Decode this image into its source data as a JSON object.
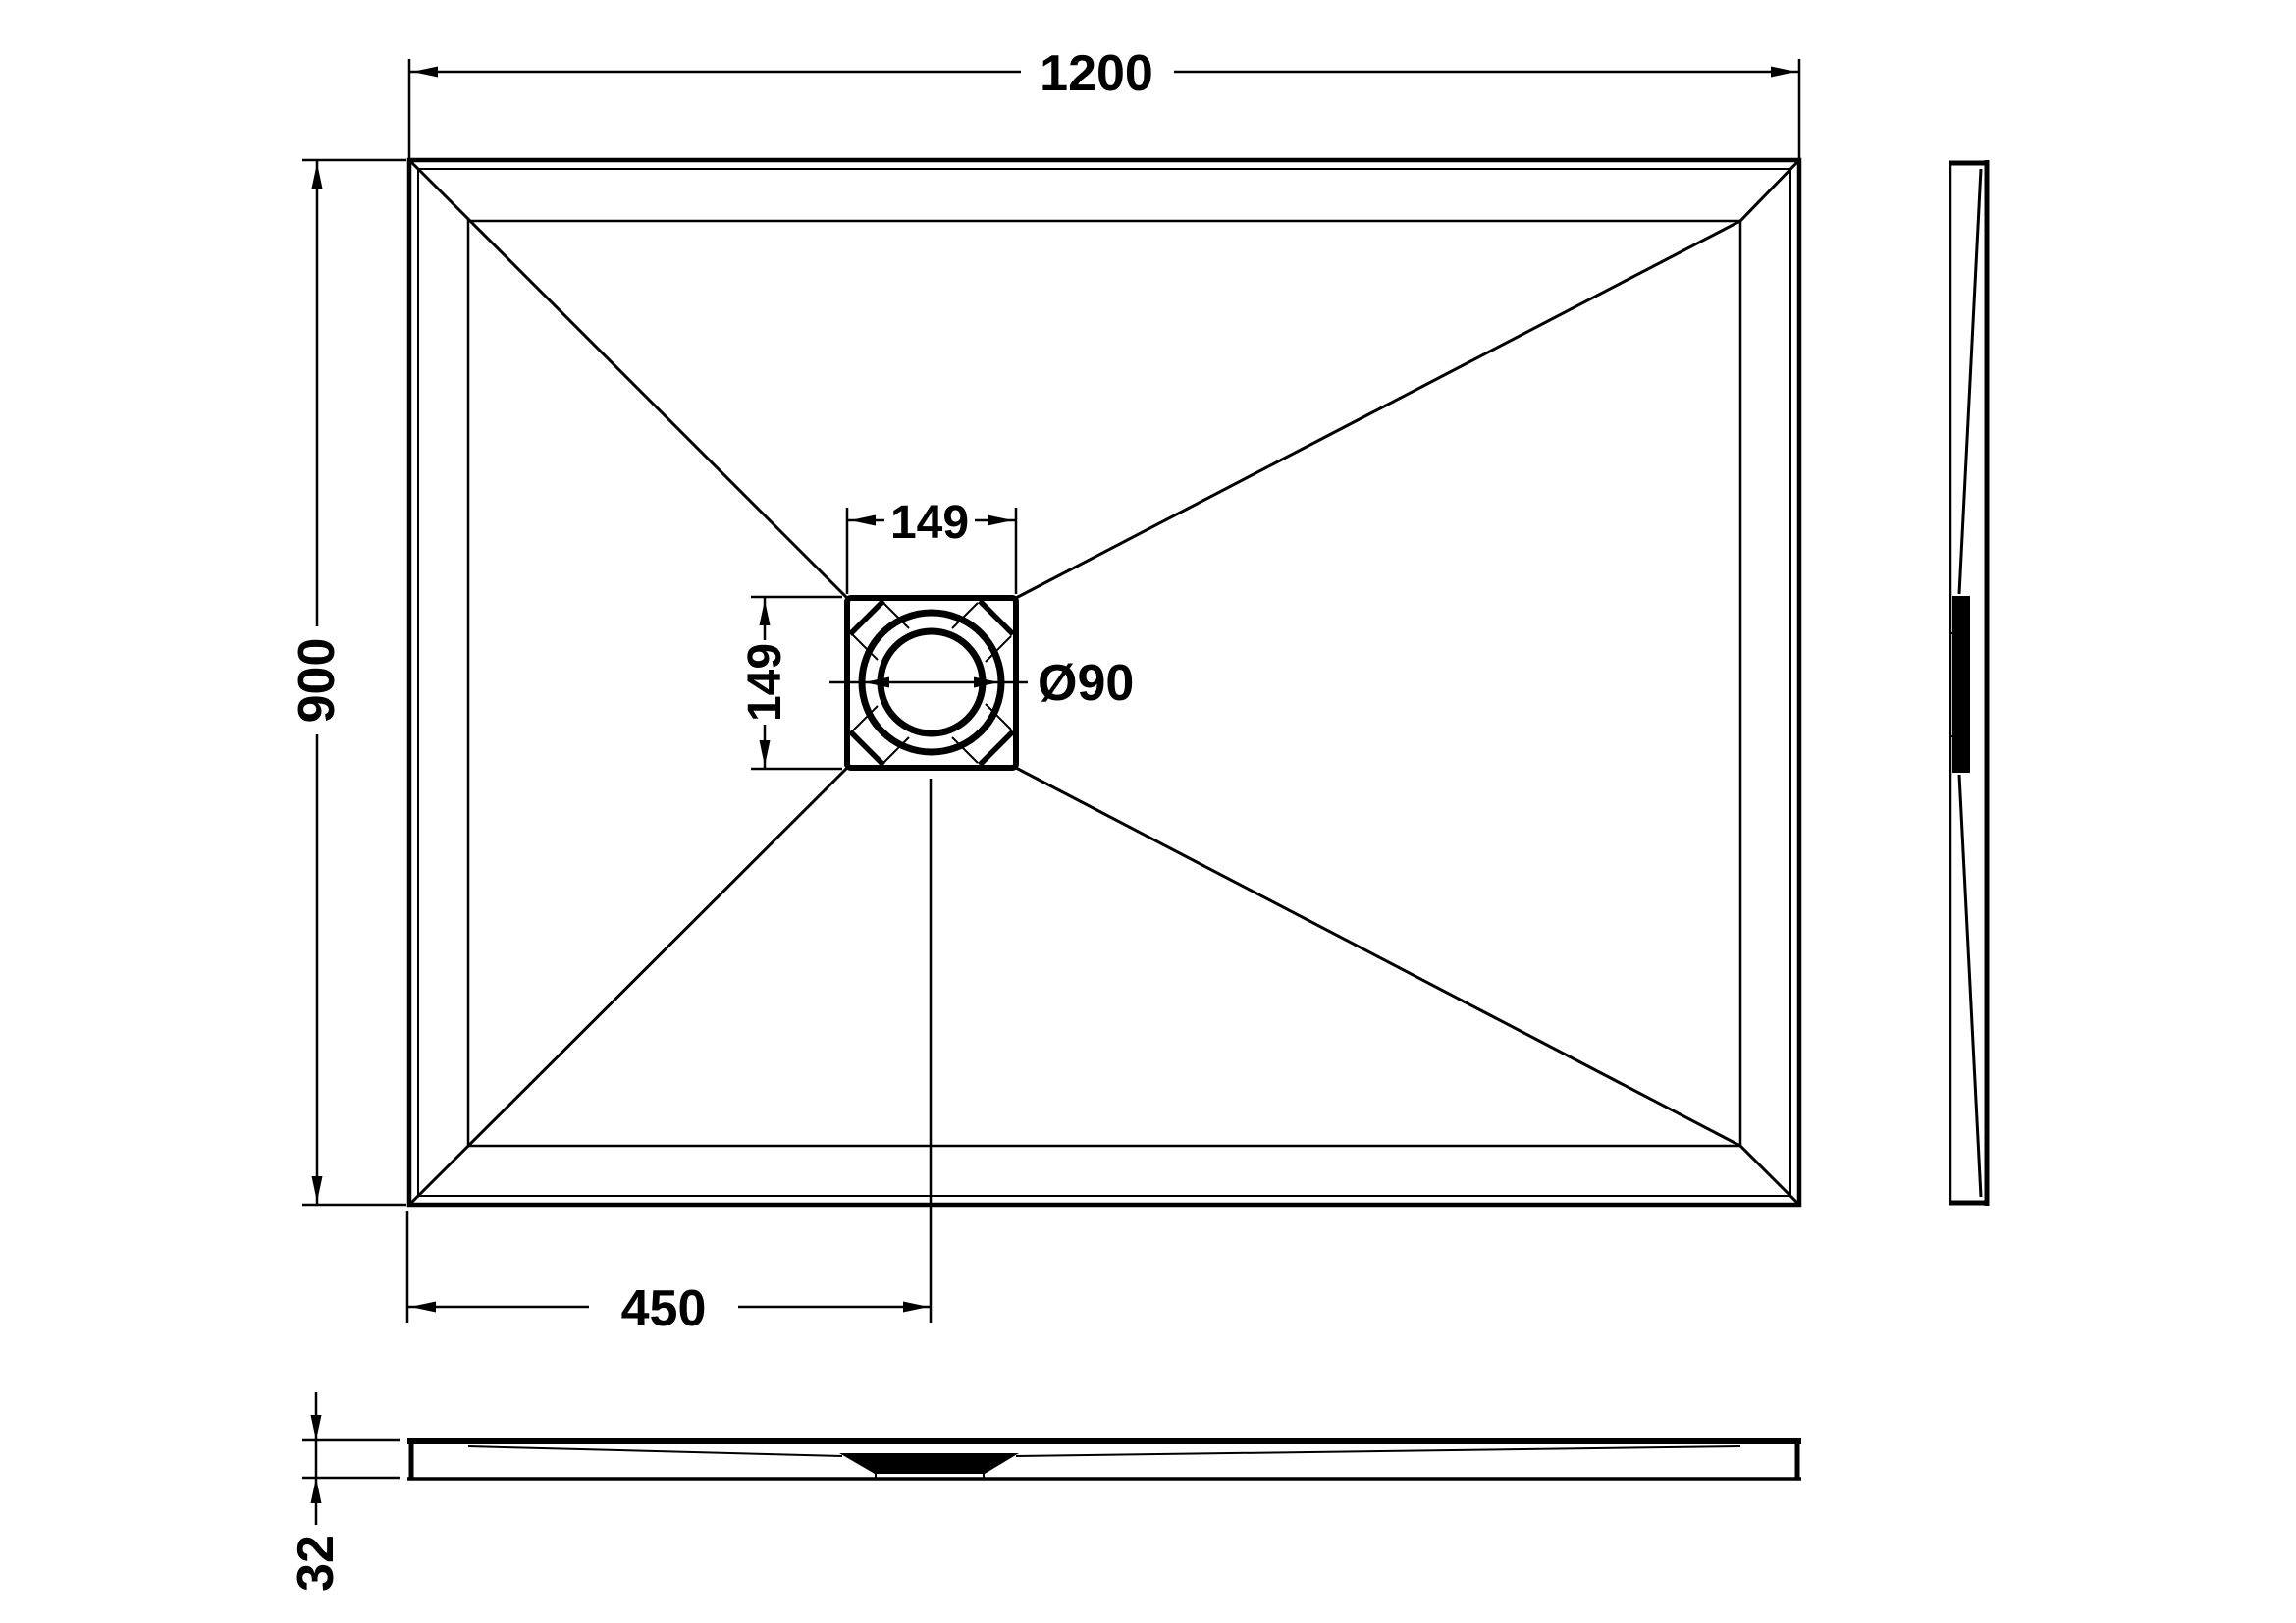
{
  "meta": {
    "background_color": "#ffffff",
    "line_color": "#000000",
    "drawing_type": "shower-tray-dimension-drawing"
  },
  "dimensions": {
    "overall_width": "1200",
    "overall_depth": "900",
    "drain_offset_from_left": "450",
    "drain_square_width": "149",
    "drain_square_depth": "149",
    "drain_diameter": "Ø90",
    "tray_thickness": "32"
  }
}
